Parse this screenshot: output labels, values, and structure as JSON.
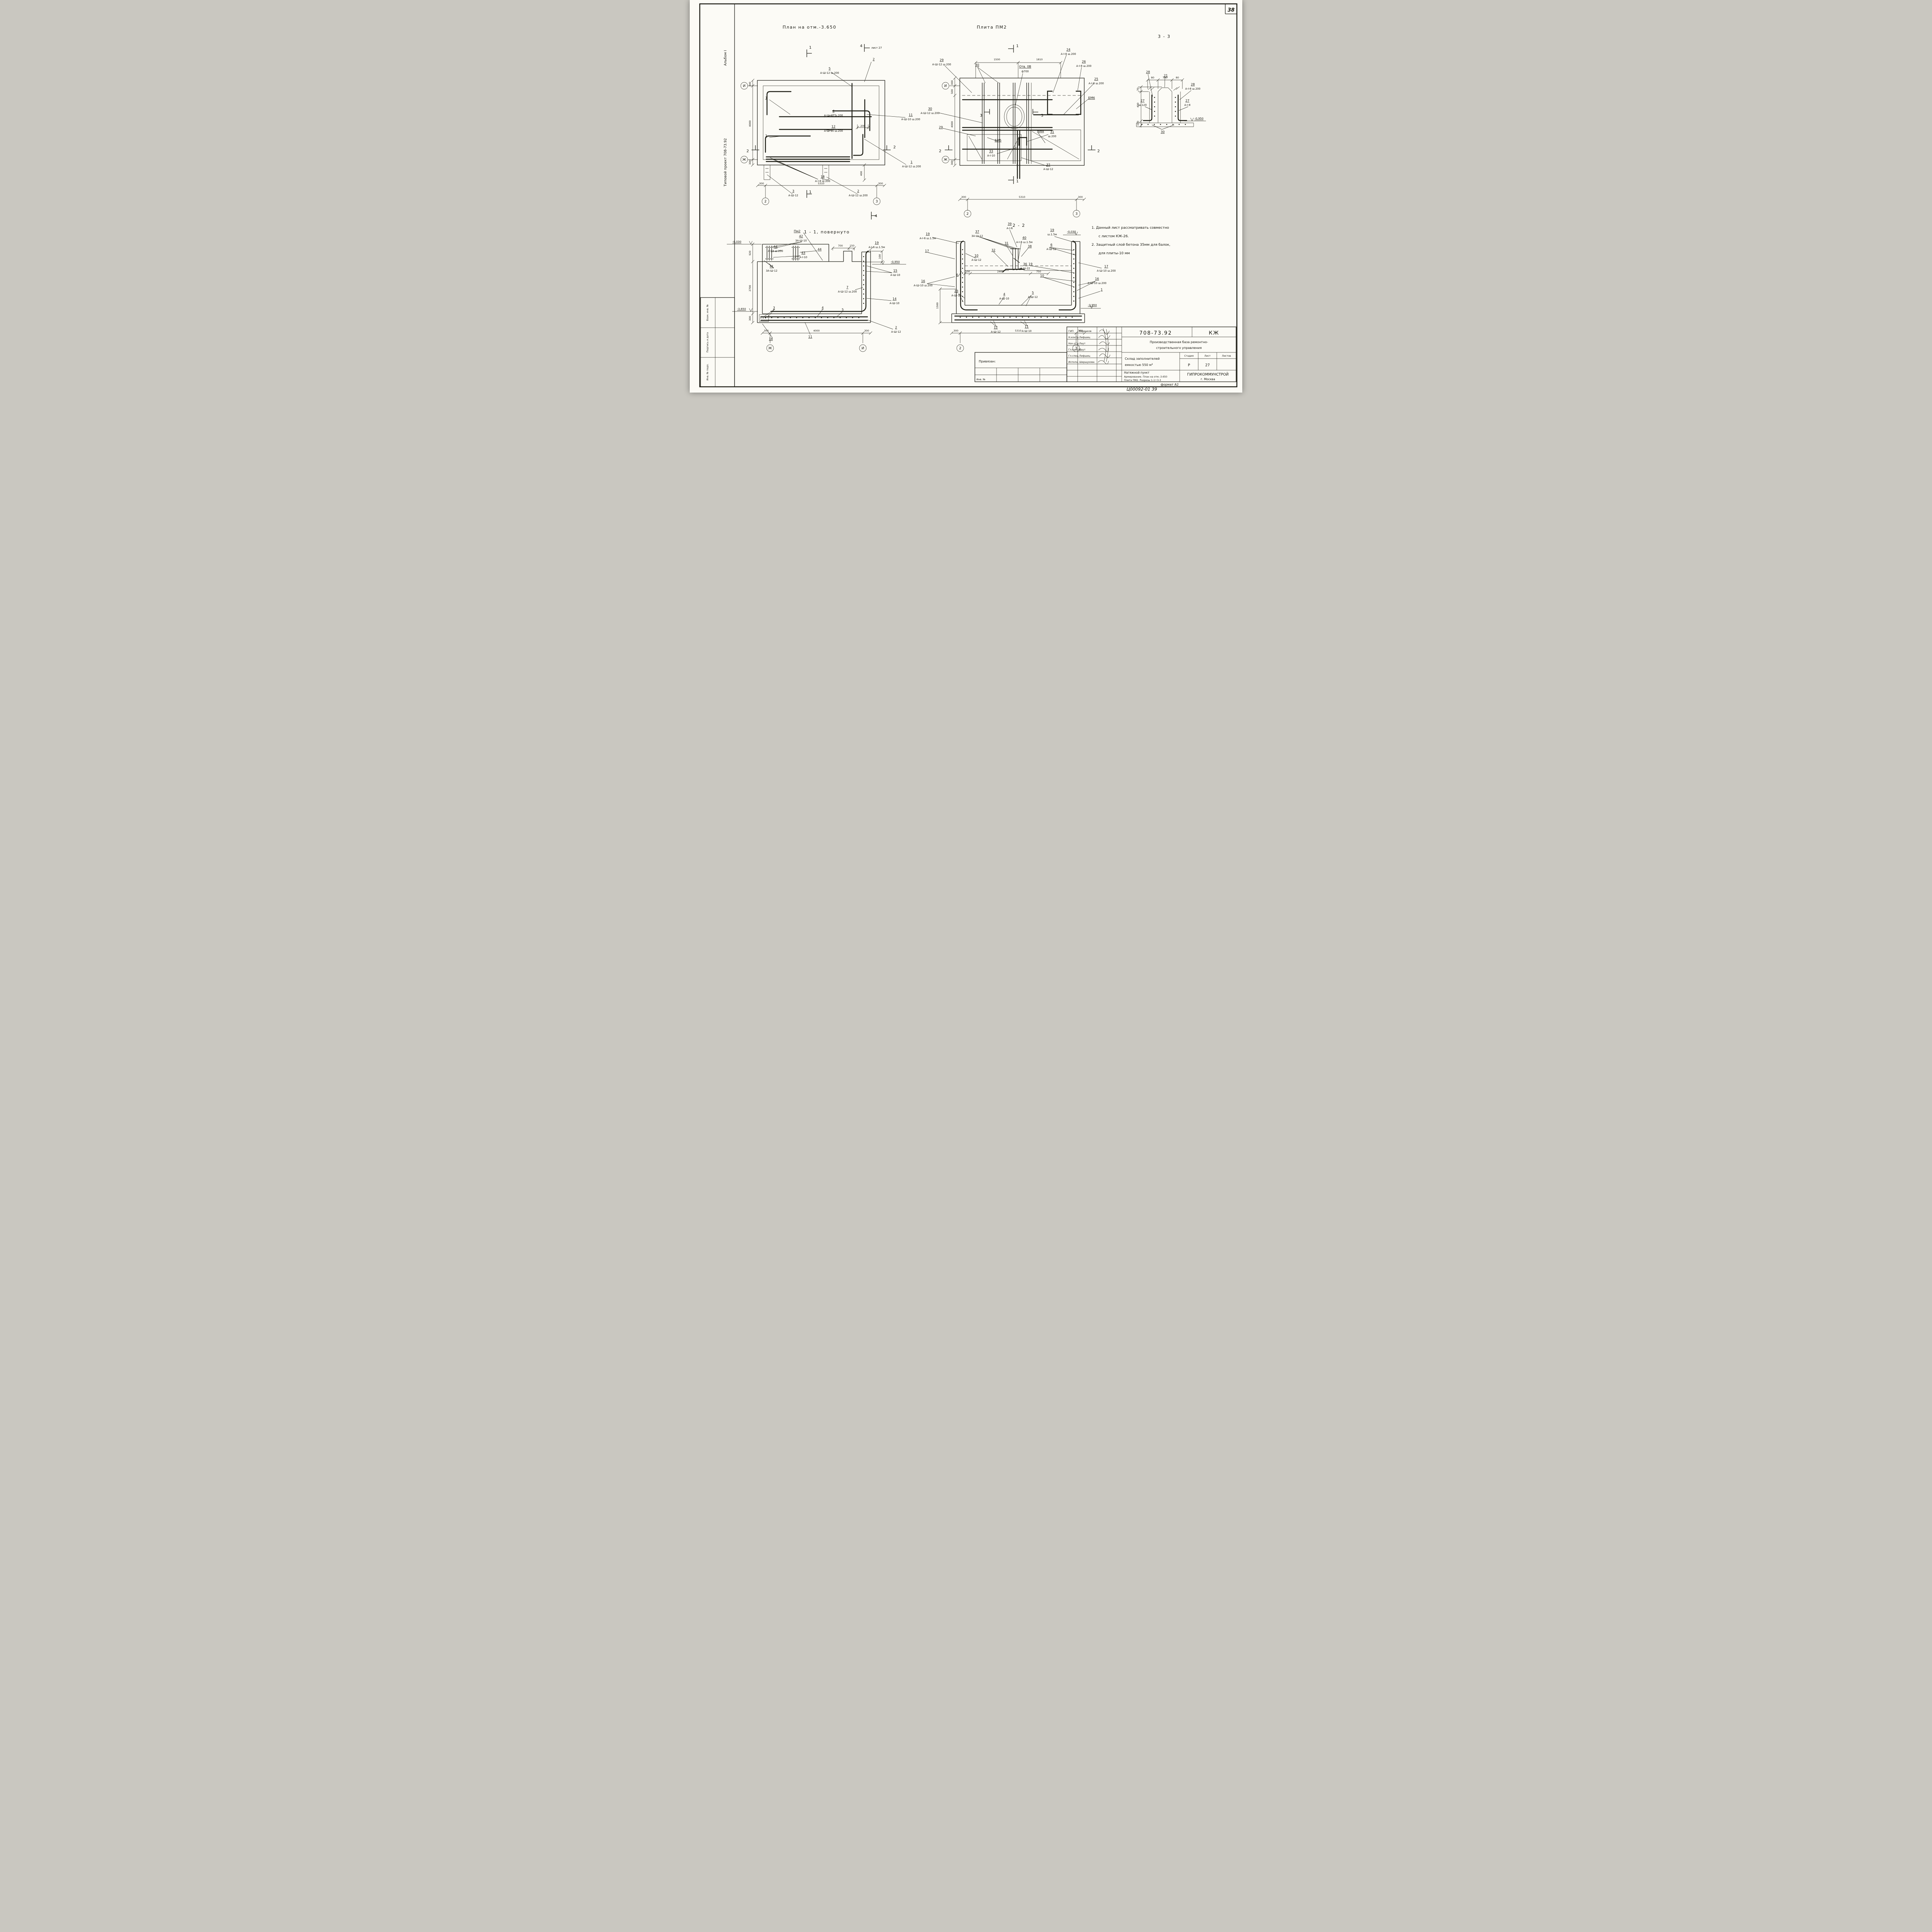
{
  "sheet": {
    "page": "38",
    "format": "формат А2",
    "inv_hand": "Ц00092-01  39"
  },
  "margin": {
    "album": "Альбом I",
    "project": "Типовой  проект  708-73.92",
    "r1": "Взам. инв. №",
    "r2": "Подпись и дата",
    "r3": "Инв. № подл."
  },
  "p1": {
    "title": "План на отм.-3.650",
    "dims": {
      "l1": "300",
      "l2": "4000",
      "l3": "300",
      "b1": "300",
      "b2": "5310",
      "b3": "300",
      "d200": "200",
      "d400": "400"
    },
    "axes": {
      "i": "И",
      "zh": "Ж",
      "c2": "2",
      "c3": "3"
    },
    "sec": {
      "s1": "1",
      "s2": "2",
      "s4": "4",
      "sheet27": "лист 27"
    },
    "c": {
      "c5n": "5",
      "c5s": "А-Ш-12 ш.200",
      "c2n": "2",
      "c1n": "1",
      "c4n": "4",
      "c4s": "А-Ш-12 ш.200",
      "c11n": "11",
      "c11s": "А-Ш-10 ш.200",
      "c12n": "12",
      "c12s": "А-Ш-10 ш.200",
      "c1rn": "1",
      "c1rs": "А-Ш-12 ш.200",
      "c18n": "18",
      "c18s": "А-I-8  ш.200",
      "c3n": "3",
      "c3s": "А-Ш-12",
      "c2bn": "2",
      "c2bs": "А-Ш-12 ш.200"
    }
  },
  "p2": {
    "title": "Плита ПМ2",
    "dims": {
      "t1": "1500",
      "t2": "1810",
      "l1": "300",
      "l2": "500",
      "l3": "4000",
      "l4": "300",
      "b1": "300",
      "b2": "5310",
      "b3": "300"
    },
    "axes": {
      "i": "И",
      "zh": "Ж",
      "c2": "2",
      "c3": "3"
    },
    "sec": {
      "s1": "1",
      "s2": "2",
      "s3": "3"
    },
    "c": {
      "otv1": "Отв. 0В",
      "otv2": "ф700",
      "c29n": "29",
      "c29s": "А-Ш-12 ш.200",
      "c30n": "30",
      "c30ln": "30",
      "c30ls": "А-Ш-12 ш.200",
      "c24n": "24",
      "c24s": "А-I-8  ш.200",
      "c26n": "26",
      "c26s": "А-I-8  ш.200",
      "c25n": "25",
      "c25s": "А-I-8  ш.200",
      "bm6": "БМ6",
      "bm5": "БМ5",
      "bm4": "БМ4",
      "c31n": "31",
      "c31s": "ш.200",
      "c33n": "33",
      "c33s": "А-I-10",
      "c32n": "32",
      "c32s": "А-Ш-12",
      "c29b": "29"
    }
  },
  "s33": {
    "title": "3 - 3",
    "dims": {
      "t1": "80",
      "t2": "700",
      "t3": "80",
      "l1": "70",
      "l2": "400",
      "l3": "100"
    },
    "lvl": "-0,950",
    "c": {
      "c28n": "28",
      "c21n": "21",
      "c28rn": "28",
      "c28rs": "А-I-8  ш.200",
      "c27ln": "27",
      "c27ls": "ш.120",
      "c27rn": "27",
      "c27rs": "А-I-8",
      "c30n": "30"
    }
  },
  "s11": {
    "title": "1 - 1, повернуто",
    "lv030": "-0,030",
    "lv950": "-0,950",
    "lv3650": "-3,650",
    "pm2": "Пм2",
    "dims": {
      "d700": "700",
      "d150": "150",
      "d100": "100",
      "l1": "920",
      "l2": "2700",
      "l3": "300",
      "b1": "300",
      "b2": "4000",
      "b3": "300"
    },
    "axes": {
      "zh": "Ж",
      "i": "И"
    },
    "c": {
      "c42n": "42",
      "c42s": "3А-Ш-10",
      "c44n": "44",
      "c44s": "А-I-8 ш.200",
      "c43n": "43",
      "c43s": "А-I-10",
      "c44b": "44",
      "c41n": "41",
      "c41s": "3А-Ш-12",
      "c19n": "19",
      "c19s": "А-I-6 ш.1.5м",
      "c15n": "15",
      "c15s": "А-Ш-10",
      "c7n": "7",
      "c7s": "А-Ш-12 ш.200",
      "c14n": "14",
      "c14s": "А-Ш-10",
      "c3": "3",
      "c4": "4",
      "c5": "5",
      "c11": "11",
      "c18": "18",
      "c2n": "2",
      "c2s": "А-Ш-12"
    }
  },
  "s22": {
    "title": "2 - 2",
    "lv030": "-0,030",
    "lv3950": "-3,950",
    "dims": {
      "d100": "100",
      "d2460": "2460",
      "d750": "750",
      "d1500": "1500",
      "b1": "300",
      "b2": "5310",
      "b3": "300"
    },
    "axes": {
      "c2": "2",
      "c3": "3"
    },
    "c": {
      "c19ln": "19",
      "c19ls": "А-I-6 ш.1.5м",
      "c37n": "37",
      "c37s": "3А-Ш-12",
      "c39n": "39",
      "c39s": "А-I-6",
      "c40n": "40",
      "c40s": "А-I-6  ш.1.5м",
      "c19rn": "19",
      "c19rs": "ш.1.5м",
      "c32": "32",
      "c31": "31",
      "c38": "38",
      "c6n": "6",
      "c6s": "А-Ш-12",
      "c36n": "36",
      "c36s": "А-Ш-22",
      "c17l": "17",
      "c17rn": "17",
      "c17rs": "А-Ш-10  ш.200",
      "c10n": "10",
      "c10s": "А-Ш-12",
      "c16ln": "16",
      "c16ls": "А-Ш-10 ш.200",
      "c19m": "19",
      "c10b": "10",
      "c16rn": "16",
      "c16rs": "А-Ш-10 ш.200",
      "c1": "1",
      "c6b": "6",
      "c23n": "23",
      "c23s": "А-Ш-12",
      "c4n": "4",
      "c4s": "А-Ш-10",
      "c5n": "5",
      "c5s": "А-Ш-12",
      "c12n": "12",
      "c12s": "А-Ш-12",
      "c11n": "11",
      "c11s": "А-Ш-10"
    }
  },
  "notes": {
    "n1a": "1.  Данный  лист  рассматривать  совместно",
    "n1b": "с  листом     КЖ-26.",
    "n2a": "2.  Защитный  слой  бетона  35мм  для  балок,",
    "n2b": "для  плиты-10 мм"
  },
  "tb": {
    "code": "708-73.92",
    "mark": "КЖ",
    "org1": "Производственная  база  ремонтно-",
    "org2": "строительного  управления",
    "obj1": "Склад  заполнителей",
    "obj2": "емкостью  550 м³",
    "stage_l": "Стадия",
    "sheet_l": "Лист",
    "sheets_l": "Листов",
    "stage": "Р",
    "sheet": "27",
    "cont1": "Натяжной  пункт",
    "cont2": "Армирование. План на отм.-3.650",
    "cont3": "Плита ПМ2. Разрезы 1-1÷3-3",
    "org": "ГИПРОКОММУНСТРОЙ",
    "city": "г. Москва",
    "attach": "Привязан:",
    "inv": "Инв. №",
    "r1l": "ГИП",
    "r1n": "Коренков",
    "r2l": "Н.контр.",
    "r2n": "Лифшиц",
    "r3l": "Нач.отд.",
    "r3n": "Лаут",
    "r4l": "Гл.констр.",
    "r4n": "Лаут",
    "r5l": "Гл.спец.",
    "r5n": "Лифшиц",
    "r6l": "Исполн.",
    "r6n": "Шершукова"
  }
}
